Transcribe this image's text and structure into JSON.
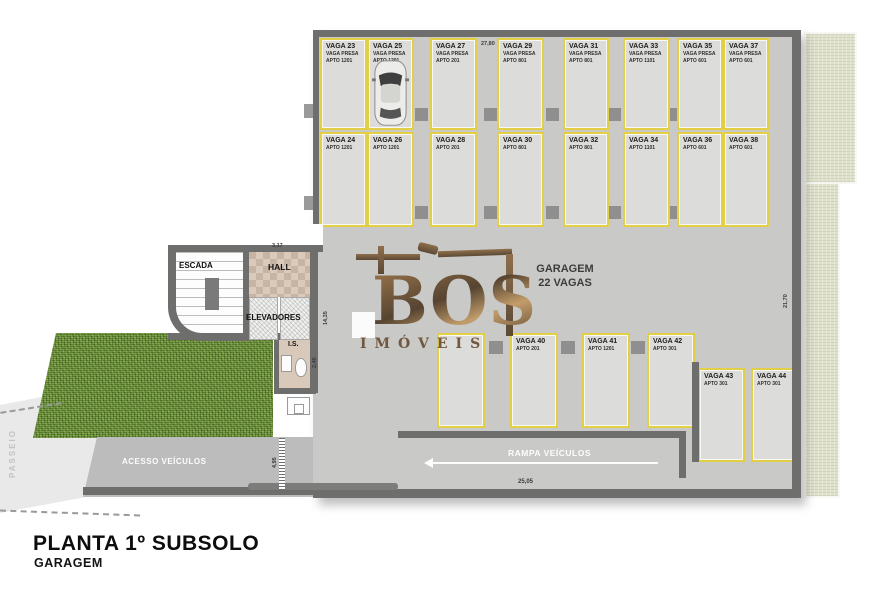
{
  "title": {
    "line1": "PLANTA 1º SUBSOLO",
    "line2": "GARAGEM"
  },
  "garage_label": {
    "line1": "GARAGEM",
    "line2": "22 VAGAS"
  },
  "watermark": {
    "brand": "BOS",
    "sub": "IMÓVEIS"
  },
  "rooms": {
    "escada": "ESCADA",
    "hall": "HALL",
    "elevadores": "ELEVADORES",
    "is": "I.S.",
    "passeio": "PASSEIO",
    "acesso": "ACESSO VEÍCULOS",
    "rampa": "RAMPA VEÍCULOS"
  },
  "dims": {
    "top_span": "27,80",
    "right_span": "21,70",
    "hall_width": "3,17",
    "core_height": "14,35",
    "is_height": "2,40",
    "access_height": "4,95",
    "ramp_width": "25,05"
  },
  "stalls": {
    "row1": [
      {
        "label": "VAGA 23",
        "sub": "VAGA PRESA",
        "apto": "APTO 1201"
      },
      {
        "label": "VAGA 25",
        "sub": "VAGA PRESA",
        "apto": "APTO 1201"
      },
      {
        "label": "VAGA 27",
        "sub": "VAGA PRESA",
        "apto": "APTO 201"
      },
      {
        "label": "VAGA 29",
        "sub": "VAGA PRESA",
        "apto": "APTO 801"
      },
      {
        "label": "VAGA 31",
        "sub": "VAGA PRESA",
        "apto": "APTO 801"
      },
      {
        "label": "VAGA 33",
        "sub": "VAGA PRESA",
        "apto": "APTO 1101"
      },
      {
        "label": "VAGA 35",
        "sub": "VAGA PRESA",
        "apto": "APTO 601"
      },
      {
        "label": "VAGA 37",
        "sub": "VAGA PRESA",
        "apto": "APTO 601"
      }
    ],
    "row2": [
      {
        "label": "VAGA 24",
        "apto": "APTO 1201"
      },
      {
        "label": "VAGA 26",
        "apto": "APTO 1201"
      },
      {
        "label": "VAGA 28",
        "apto": "APTO 201"
      },
      {
        "label": "VAGA 30",
        "apto": "APTO 801"
      },
      {
        "label": "VAGA 32",
        "apto": "APTO 801"
      },
      {
        "label": "VAGA 34",
        "apto": "APTO 1101"
      },
      {
        "label": "VAGA 36",
        "apto": "APTO 601"
      },
      {
        "label": "VAGA 38",
        "apto": "APTO 601"
      }
    ],
    "row3": [
      {
        "label": "",
        "apto": ""
      },
      {
        "label": "VAGA 40",
        "apto": "APTO 201"
      },
      {
        "label": "VAGA 41",
        "apto": "APTO 1201"
      },
      {
        "label": "VAGA 42",
        "apto": "APTO 301"
      }
    ],
    "row4": [
      {
        "label": "VAGA 43",
        "apto": "APTO 301"
      },
      {
        "label": "VAGA 44",
        "apto": "APTO 301"
      }
    ]
  },
  "colors": {
    "stall_border": "#e2cf45",
    "floor": "#c9c9c7",
    "wall": "#6e6e6d",
    "grass": "#6d903c",
    "logo_bronze": "#6b4f33",
    "exterior_beige": "#e0e1cb"
  }
}
